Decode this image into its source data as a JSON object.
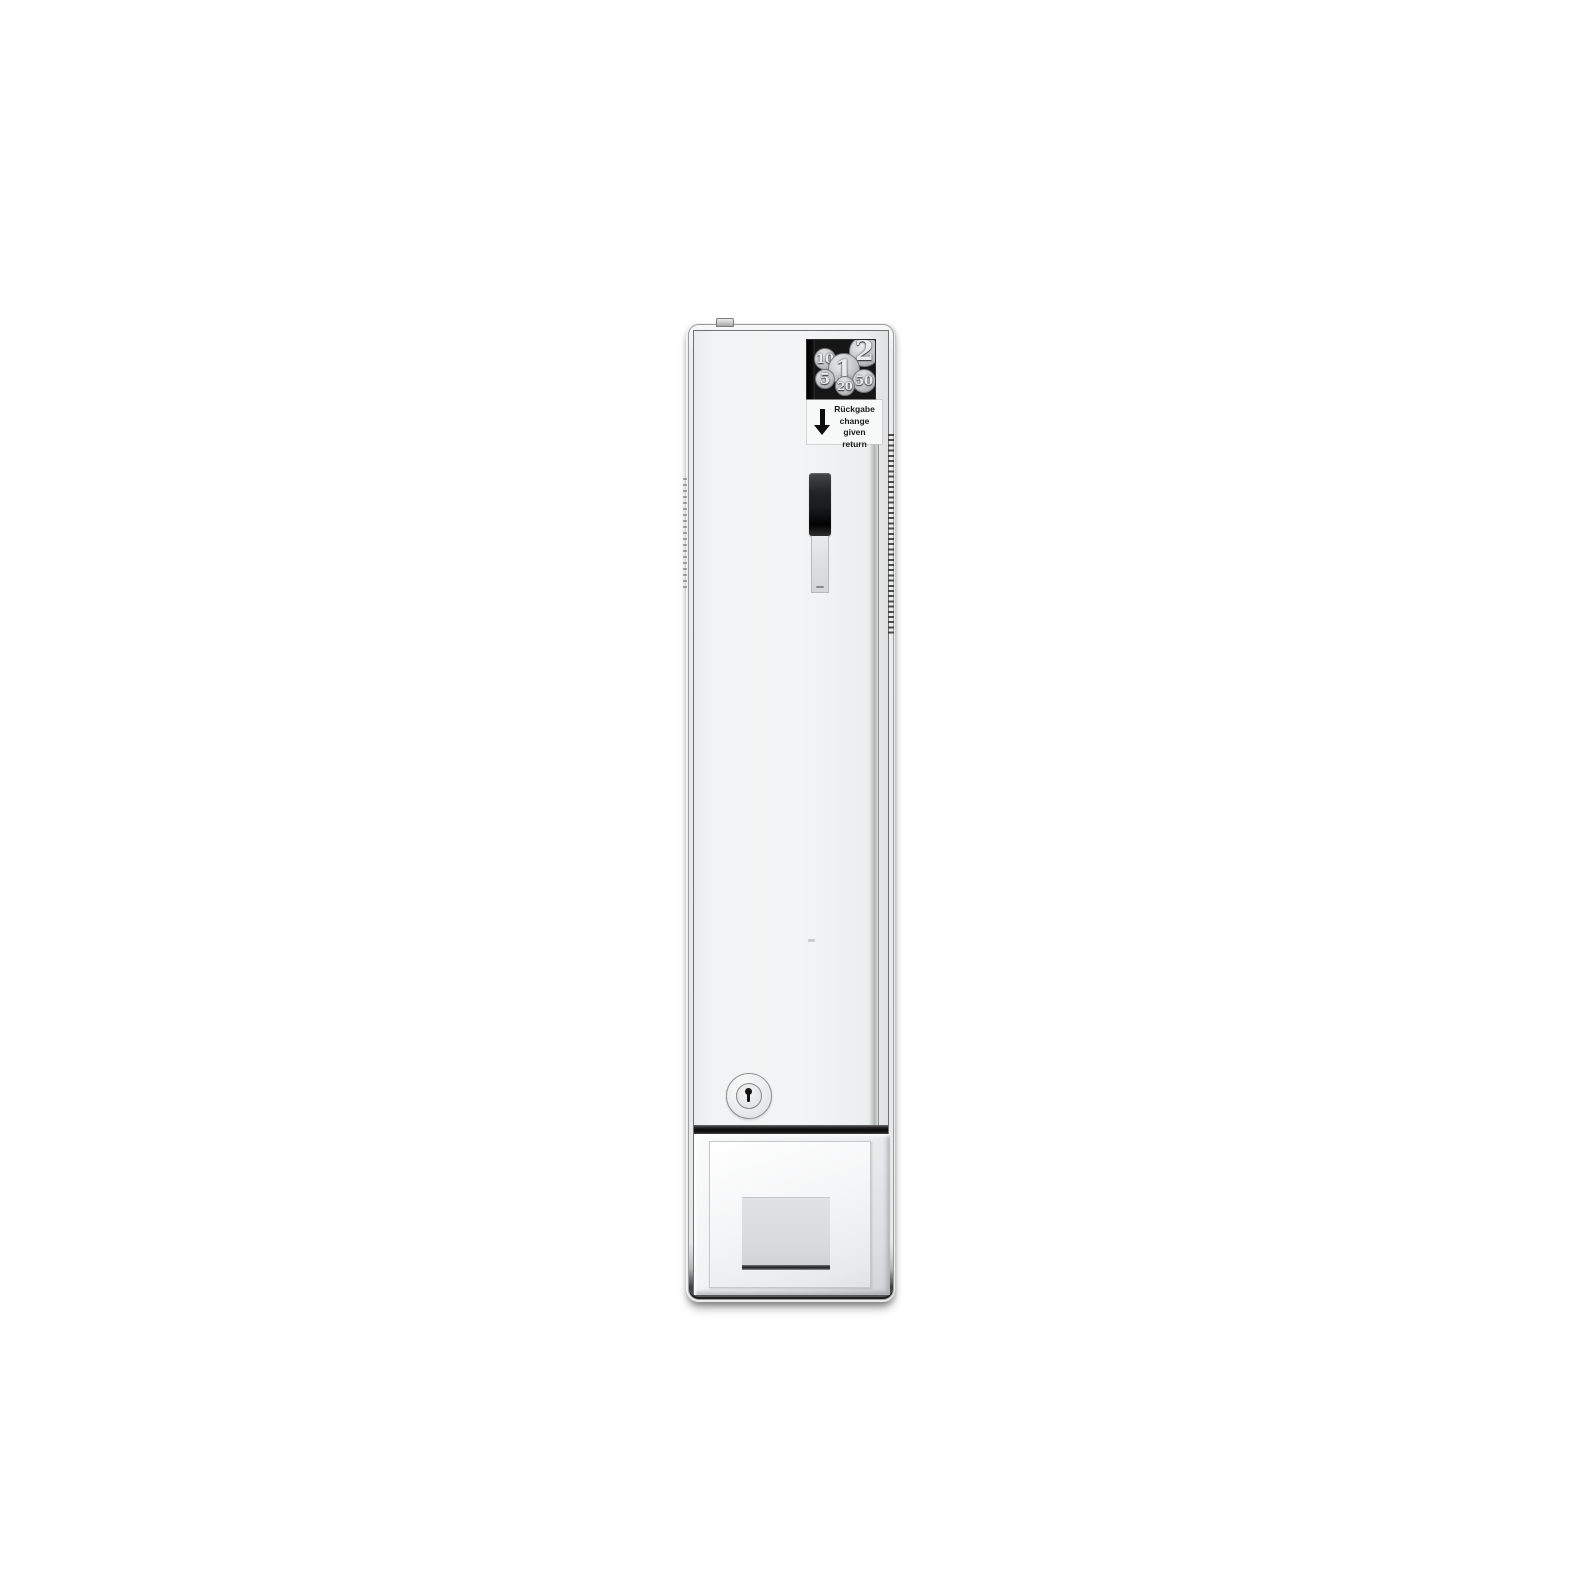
{
  "machine": {
    "coin_panel": {
      "coins": [
        {
          "value": "10"
        },
        {
          "value": "1"
        },
        {
          "value": "2"
        },
        {
          "value": "5"
        },
        {
          "value": "20"
        },
        {
          "value": "50"
        }
      ]
    },
    "return_label": {
      "title_de": "Rückgabe",
      "line_change": "change given",
      "line_return": "return",
      "arrow_icon": "down-arrow"
    },
    "colors": {
      "frame_chrome_light": "#f2f2f2",
      "frame_chrome_dark": "#3c3c3c",
      "door_white": "#f1f3f4",
      "coin_panel_black": "#161616",
      "coin_silver": "#c2c4c6",
      "slot_black": "#111111",
      "slide_handle_gray": "#dcdee0",
      "label_bg": "#f7f8f8",
      "label_text": "#1b1b1b",
      "separator_dark": "#0a0a0a",
      "flap_gray": "#d6d8da"
    }
  }
}
